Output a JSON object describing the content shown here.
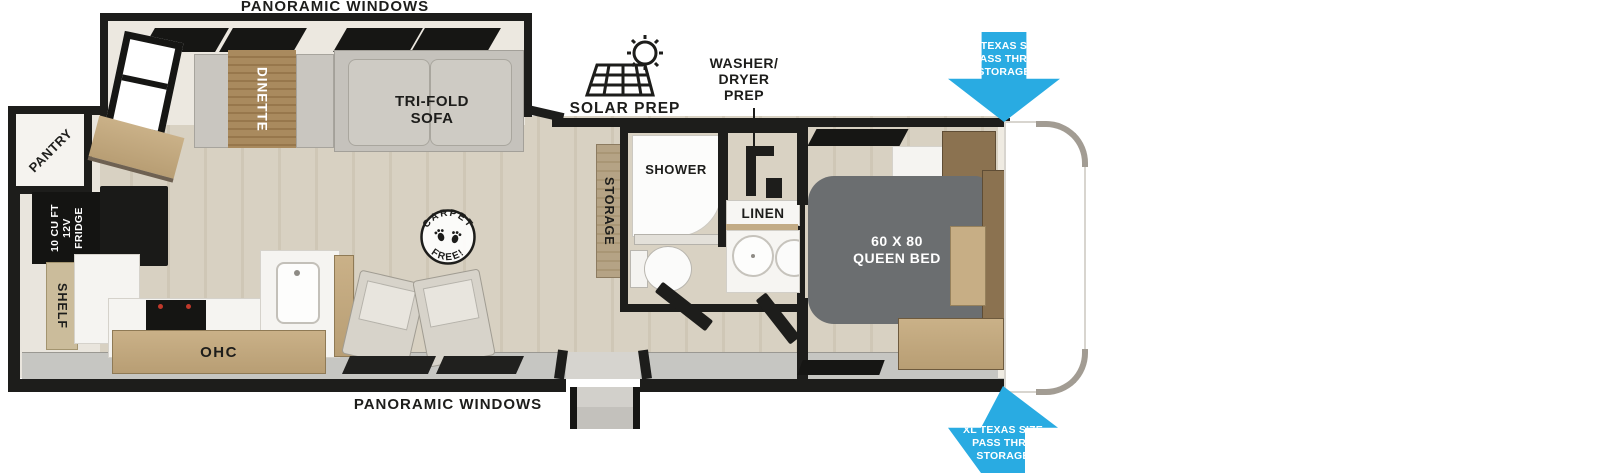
{
  "meta": {
    "kind": "rv-floorplan-diagram"
  },
  "colors": {
    "wall": "#1d1d1b",
    "arrow_blue": "#29abe2",
    "floor_wood": "#d6cfc1",
    "cabinet_wood": "#c2a982",
    "bed_gray": "#6b6e70",
    "slide_interior": "#ece8e0"
  },
  "labels": {
    "panoramic_top": "PANORAMIC WINDOWS",
    "panoramic_bottom": "PANORAMIC WINDOWS",
    "dinette": "DINETTE",
    "trifold_sofa": "TRI-FOLD\nSOFA",
    "solar_prep": "SOLAR PREP",
    "washer_dryer_prep": "WASHER/\nDRYER\nPREP",
    "pass_thru_top": "XL TEXAS SIZE\nPASS THRU\nSTORAGE",
    "pass_thru_bottom": "XL TEXAS SIZE\nPASS THRU\nSTORAGE",
    "pantry": "PANTRY",
    "fridge": "10 CU FT\n12V\nFRIDGE",
    "shelf": "SHELF",
    "ohc_kitchen": "OHC",
    "storage": "STORAGE",
    "shower": "SHOWER",
    "linen": "LINEN",
    "queen_bed": "60 X 80\nQUEEN BED",
    "ohc_bedroom": "OHC",
    "carpet_stamp_top": "CARPET",
    "carpet_stamp_bottom": "FREE!"
  }
}
